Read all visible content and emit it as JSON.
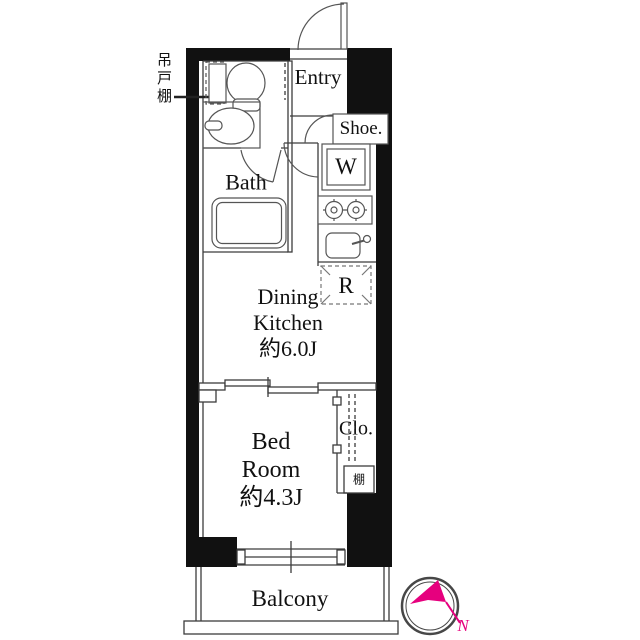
{
  "floor_plan": {
    "labels": {
      "entry": "Entry",
      "shoe": "Shoe.",
      "washer": "W",
      "bath": "Bath",
      "dk_line1": "Dining",
      "dk_line2": "Kitchen",
      "dk_area": "約6.0J",
      "fridge": "R",
      "closet": "Clo.",
      "shelf": "棚",
      "bed_line1": "Bed",
      "bed_line2": "Room",
      "bed_area": "約4.3J",
      "balcony": "Balcony",
      "hanging_cupboard": "吊戸棚",
      "compass_north": "N"
    },
    "colors": {
      "wall": "#111111",
      "line": "#3c3c3c",
      "fixture": "#555555",
      "accent": "#e6007e"
    }
  }
}
